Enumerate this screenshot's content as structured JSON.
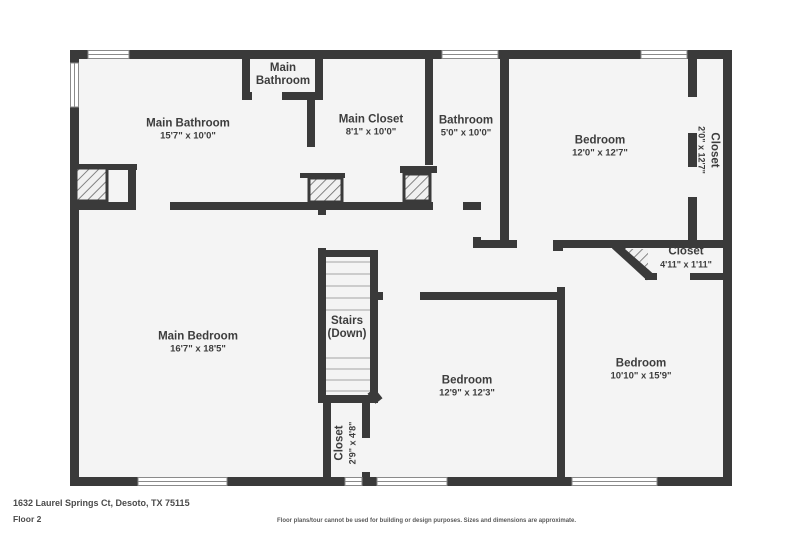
{
  "floor_plan": {
    "address": "1632 Laurel Springs Ct, Desoto, TX 75115",
    "floor_label": "Floor 2",
    "disclaimer": "Floor plans/tour cannot be used for building or design purposes. Sizes and dimensions are approximate.",
    "colors": {
      "wall": "#3a3a3a",
      "floor": "#f4f4f4",
      "label_text": "#3d3d3d",
      "window_frame": "#8a8a8a",
      "stair_tread": "#b5b5b5",
      "hatch_line": "#666666"
    },
    "rooms": {
      "main_bathroom_upper": {
        "name": "Main Bathroom",
        "dims": ""
      },
      "main_bathroom": {
        "name": "Main Bathroom",
        "dims": "15'7\" x 10'0\""
      },
      "main_closet": {
        "name": "Main Closet",
        "dims": "8'1\" x 10'0\""
      },
      "bathroom": {
        "name": "Bathroom",
        "dims": "5'0\" x 10'0\""
      },
      "bedroom_upper": {
        "name": "Bedroom",
        "dims": "12'0\" x 12'7\""
      },
      "closet_right": {
        "name": "Closet",
        "dims": "2'0\" x 12'7\""
      },
      "closet_corner": {
        "name": "Closet",
        "dims": "4'11\" x 1'11\""
      },
      "main_bedroom": {
        "name": "Main Bedroom",
        "dims": "16'7\" x 18'5\""
      },
      "stairs": {
        "name": "Stairs",
        "dims": "(Down)"
      },
      "bedroom_middle": {
        "name": "Bedroom",
        "dims": "12'9\" x 12'3\""
      },
      "bedroom_right": {
        "name": "Bedroom",
        "dims": "10'10\" x 15'9\""
      },
      "closet_lower": {
        "name": "Closet",
        "dims": "2'9\" x 4'8\""
      }
    }
  }
}
